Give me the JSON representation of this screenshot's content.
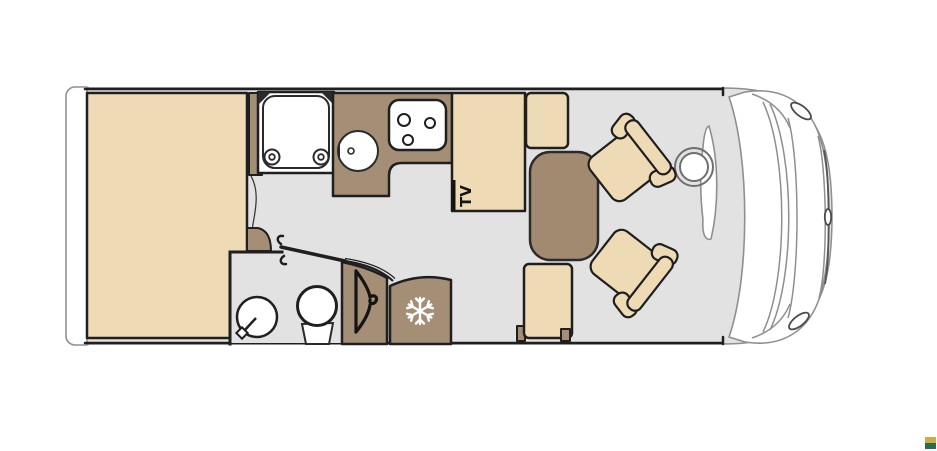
{
  "title": "Motorhome floor plan",
  "plan": {
    "tv_label": "TV",
    "areas": [
      "rear-bed",
      "shower",
      "kitchen",
      "tv-cabinet",
      "dinette",
      "bathroom",
      "wardrobe",
      "refrigerator",
      "driver-cab"
    ]
  },
  "icons": {
    "snowflake": "refrigerator",
    "hanger": "wardrobe",
    "steering_wheel": "driver-cab",
    "brand_mark": "logo-square"
  },
  "colors": {
    "floor": "#e2e2e2",
    "beige": "#eedbb6",
    "brown": "#a58e76",
    "table_brown": "#a28a70",
    "dark": "#1f1f1f",
    "cab_line": "#8f8f8f",
    "logo_gold": "#d2ab43",
    "logo_green": "#23704f"
  }
}
